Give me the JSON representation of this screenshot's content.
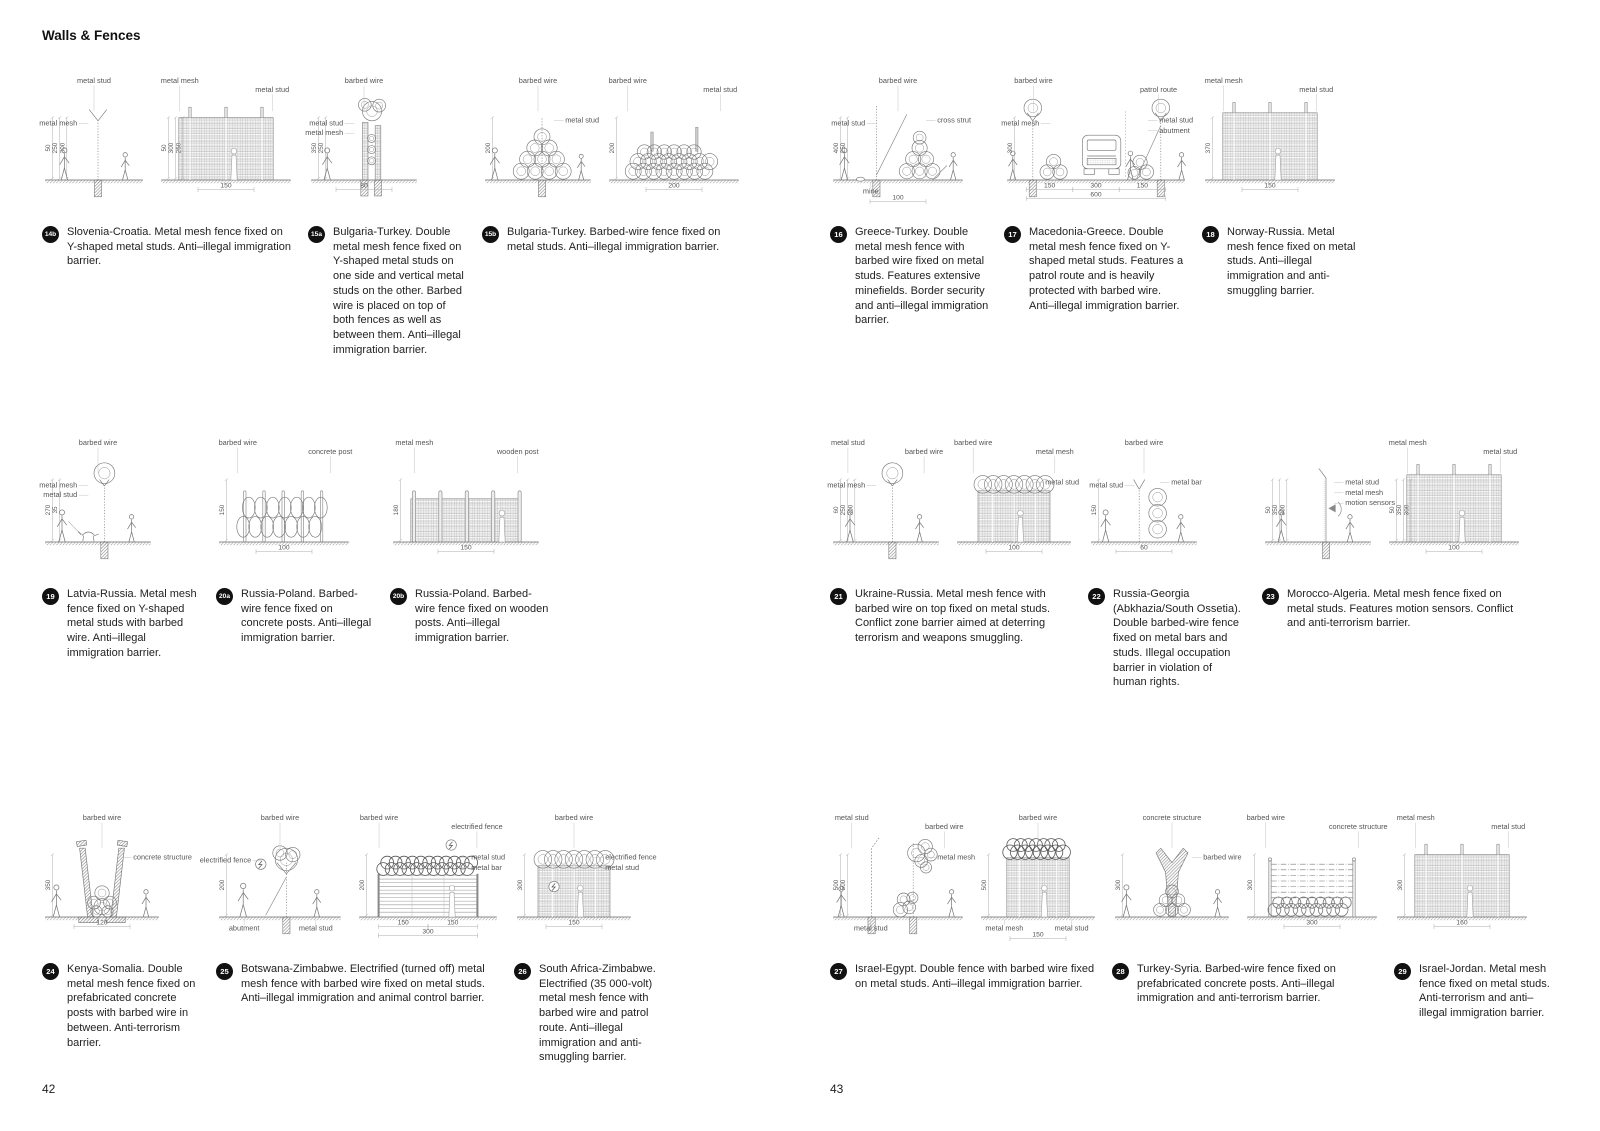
{
  "header": {
    "title": "Walls & Fences"
  },
  "colors": {
    "page_bg": "#ffffff",
    "text": "#222222",
    "badge_bg": "#111111",
    "drawing_line": "#777777",
    "dim_line": "#aaaaaa"
  },
  "pages": [
    {
      "number": "42",
      "rows": [
        [
          {
            "id": "14b",
            "caption": "Slovenia-Croatia. Metal mesh fence fixed on Y-shaped metal studs. Anti–illegal immigration barrier.",
            "drawings": [
              {
                "kind": "ypost",
                "labels": [
                  {
                    "t": "metal stud",
                    "pos": "top"
                  },
                  {
                    "t": "metal mesh",
                    "pos": "left"
                  }
                ],
                "vdims": [
                  "50",
                  "250",
                  "300"
                ],
                "hdims": []
              },
              {
                "kind": "meshwall",
                "labels": [
                  {
                    "t": "metal mesh",
                    "pos": "top"
                  },
                  {
                    "t": "metal stud",
                    "pos": "top"
                  }
                ],
                "vdims": [
                  "50",
                  "300",
                  "250"
                ],
                "hdims": [
                  "150"
                ]
              }
            ]
          },
          {
            "id": "15a",
            "caption": "Bulgaria-Turkey. Double metal mesh fence fixed on Y-shaped metal studs on one side and vertical metal studs on the other. Barbed wire is placed on top of both fences as well as between them. Anti–illegal immigration barrier.",
            "drawings": [
              {
                "kind": "doubleMeshCoil",
                "labels": [
                  {
                    "t": "barbed wire",
                    "pos": "top"
                  },
                  {
                    "t": "metal stud",
                    "pos": "left"
                  },
                  {
                    "t": "metal mesh",
                    "pos": "left"
                  }
                ],
                "vdims": [
                  "350",
                  "250"
                ],
                "hdims": [
                  "80"
                ]
              }
            ]
          },
          {
            "id": "15b",
            "caption": "Bulgaria-Turkey. Barbed-wire fence fixed on metal studs. Anti–illegal immigration barrier.",
            "drawings": [
              {
                "kind": "coilPyramid",
                "labels": [
                  {
                    "t": "barbed wire",
                    "pos": "top"
                  },
                  {
                    "t": "metal stud",
                    "pos": "right"
                  }
                ],
                "vdims": [
                  "200"
                ],
                "hdims": []
              },
              {
                "kind": "coilMound",
                "labels": [
                  {
                    "t": "barbed wire",
                    "pos": "top"
                  },
                  {
                    "t": "metal stud",
                    "pos": "top"
                  }
                ],
                "vdims": [
                  "200"
                ],
                "hdims": [
                  "200"
                ]
              }
            ]
          }
        ],
        [
          {
            "id": "19",
            "caption": "Latvia-Russia. Metal mesh fence fixed on Y-shaped metal studs with barbed wire. Anti–illegal immigration barrier.",
            "drawings": [
              {
                "kind": "postCoilTop",
                "variant": "dog",
                "labels": [
                  {
                    "t": "barbed wire",
                    "pos": "top"
                  },
                  {
                    "t": "metal mesh",
                    "pos": "left"
                  },
                  {
                    "t": "metal stud",
                    "pos": "left"
                  }
                ],
                "vdims": [
                  "270",
                  "35"
                ],
                "hdims": []
              }
            ]
          },
          {
            "id": "20a",
            "caption": "Russia-Poland. Barbed-wire fence fixed on concrete posts. Anti–illegal immigration barrier.",
            "drawings": [
              {
                "kind": "coilRows",
                "labels": [
                  {
                    "t": "barbed wire",
                    "pos": "top"
                  },
                  {
                    "t": "concrete post",
                    "pos": "top"
                  }
                ],
                "vdims": [
                  "150"
                ],
                "hdims": [
                  "100"
                ]
              }
            ]
          },
          {
            "id": "20b",
            "caption": "Russia-Poland. Barbed-wire fence fixed on wooden posts. Anti–illegal immigration barrier.",
            "drawings": [
              {
                "kind": "meshFence",
                "labels": [
                  {
                    "t": "metal mesh",
                    "pos": "top"
                  },
                  {
                    "t": "wooden post",
                    "pos": "top"
                  }
                ],
                "vdims": [
                  "180"
                ],
                "hdims": [
                  "150"
                ]
              }
            ]
          }
        ],
        [
          {
            "id": "24",
            "caption": "Kenya-Somalia. Double metal mesh fence fixed on prefabricated concrete posts with barbed wire in between. Anti-terrorism barrier.",
            "drawings": [
              {
                "kind": "vwalls",
                "labels": [
                  {
                    "t": "barbed wire",
                    "pos": "top"
                  },
                  {
                    "t": "concrete structure",
                    "pos": "right"
                  }
                ],
                "vdims": [
                  "350"
                ],
                "hdims": [
                  "120"
                ]
              }
            ]
          },
          {
            "id": "25",
            "caption": "Botswana-Zimbabwe. Electrified (turned off) metal mesh fence with barbed wire fixed on metal studs. Anti–illegal immigration and animal control barrier.",
            "drawings": [
              {
                "kind": "strutCoil",
                "labels": [
                  {
                    "t": "electrified fence",
                    "pos": "left"
                  },
                  {
                    "t": "barbed wire",
                    "pos": "top"
                  },
                  {
                    "t": "abutment",
                    "pos": "bottom"
                  },
                  {
                    "t": "metal stud",
                    "pos": "bottom"
                  }
                ],
                "vdims": [
                  "200"
                ],
                "hdims": []
              },
              {
                "kind": "barWall",
                "labels": [
                  {
                    "t": "barbed wire",
                    "pos": "top"
                  },
                  {
                    "t": "electrified fence",
                    "pos": "top"
                  },
                  {
                    "t": "metal stud",
                    "pos": "right"
                  },
                  {
                    "t": "metal bar",
                    "pos": "right"
                  }
                ],
                "vdims": [
                  "200"
                ],
                "hdims": [
                  "150",
                  "150",
                  "300"
                ]
              }
            ]
          },
          {
            "id": "26",
            "caption": "South Africa-Zimbabwe. Electrified (35 000-volt) metal mesh fence with barbed wire and patrol route. Anti–illegal immigration and anti-smuggling barrier.",
            "drawings": [
              {
                "kind": "meshCoilTop",
                "variant": "bolt",
                "labels": [
                  {
                    "t": "barbed wire",
                    "pos": "top"
                  },
                  {
                    "t": "electrified fence",
                    "pos": "right"
                  },
                  {
                    "t": "metal stud",
                    "pos": "right"
                  }
                ],
                "vdims": [
                  "300"
                ],
                "hdims": [
                  "150"
                ]
              }
            ]
          }
        ]
      ]
    },
    {
      "number": "43",
      "rows": [
        [
          {
            "id": "16",
            "caption": "Greece-Turkey. Double metal mesh fence with barbed wire fixed on metal studs. Features extensive minefields. Border security and anti–illegal immigration barrier.",
            "drawings": [
              {
                "kind": "mineSection",
                "labels": [
                  {
                    "t": "barbed wire",
                    "pos": "top"
                  },
                  {
                    "t": "metal stud",
                    "pos": "left"
                  },
                  {
                    "t": "cross strut",
                    "pos": "right"
                  },
                  {
                    "t": "mine",
                    "pos": "bottom"
                  }
                ],
                "vdims": [
                  "400",
                  "250"
                ],
                "hdims": [
                  "100"
                ]
              }
            ]
          },
          {
            "id": "17",
            "caption": "Macedonia-Greece. Double metal mesh fence fixed on Y-shaped metal studs. Features a patrol route and is heavily protected with barbed wire. Anti–illegal immigration barrier.",
            "drawings": [
              {
                "kind": "patrol",
                "labels": [
                  {
                    "t": "barbed wire",
                    "pos": "top"
                  },
                  {
                    "t": "patrol route",
                    "pos": "top"
                  },
                  {
                    "t": "metal mesh",
                    "pos": "left"
                  },
                  {
                    "t": "metal stud",
                    "pos": "right"
                  },
                  {
                    "t": "abutment",
                    "pos": "right"
                  }
                ],
                "vdims": [
                  "300"
                ],
                "hdims": [
                  "150",
                  "300",
                  "150",
                  "600"
                ]
              }
            ]
          },
          {
            "id": "18",
            "caption": "Norway-Russia. Metal mesh fence fixed on metal studs. Anti–illegal immigration and anti-smuggling barrier.",
            "drawings": [
              {
                "kind": "meshwall",
                "variant": "tall",
                "labels": [
                  {
                    "t": "metal mesh",
                    "pos": "top"
                  },
                  {
                    "t": "metal stud",
                    "pos": "top"
                  }
                ],
                "vdims": [
                  "370"
                ],
                "hdims": [
                  "150"
                ]
              }
            ]
          }
        ],
        [
          {
            "id": "21",
            "caption": "Ukraine-Russia. Metal mesh fence with barbed wire on top fixed on metal studs. Conflict zone barrier aimed at deterring terrorism and weapons smuggling.",
            "drawings": [
              {
                "kind": "postCoilTop",
                "labels": [
                  {
                    "t": "metal stud",
                    "pos": "top"
                  },
                  {
                    "t": "barbed wire",
                    "pos": "top"
                  },
                  {
                    "t": "metal mesh",
                    "pos": "left"
                  }
                ],
                "vdims": [
                  "60",
                  "250",
                  "300"
                ],
                "hdims": []
              },
              {
                "kind": "meshCoilTop",
                "labels": [
                  {
                    "t": "barbed wire",
                    "pos": "top"
                  },
                  {
                    "t": "metal mesh",
                    "pos": "top"
                  },
                  {
                    "t": "metal stud",
                    "pos": "right"
                  }
                ],
                "vdims": [],
                "hdims": [
                  "100"
                ]
              }
            ]
          },
          {
            "id": "22",
            "caption": "Russia-Georgia (Abkhazia/South Ossetia). Double barbed-wire fence fixed on metal bars and studs. Illegal occupation barrier in violation of human rights.",
            "drawings": [
              {
                "kind": "ysmallCoils",
                "labels": [
                  {
                    "t": "metal stud",
                    "pos": "left"
                  },
                  {
                    "t": "barbed wire",
                    "pos": "top"
                  },
                  {
                    "t": "metal bar",
                    "pos": "right"
                  }
                ],
                "vdims": [
                  "150"
                ],
                "hdims": [
                  "60"
                ]
              }
            ]
          },
          {
            "id": "23",
            "caption": "Morocco-Algeria. Metal mesh fence fixed on metal studs. Features motion sensors. Conflict and anti-terrorism barrier.",
            "drawings": [
              {
                "kind": "sensorPost",
                "labels": [
                  {
                    "t": "metal stud",
                    "pos": "right"
                  },
                  {
                    "t": "metal mesh",
                    "pos": "right"
                  },
                  {
                    "t": "motion sensors",
                    "pos": "right"
                  }
                ],
                "vdims": [
                  "50",
                  "350",
                  "300"
                ],
                "hdims": []
              },
              {
                "kind": "meshwall",
                "variant": "tall",
                "labels": [
                  {
                    "t": "metal mesh",
                    "pos": "top"
                  },
                  {
                    "t": "metal stud",
                    "pos": "top"
                  }
                ],
                "vdims": [
                  "50",
                  "350",
                  "300"
                ],
                "hdims": [
                  "100"
                ]
              }
            ]
          }
        ],
        [
          {
            "id": "27",
            "caption": "Israel-Egypt. Double fence with barbed wire fixed on metal studs. Anti–illegal immigration barrier.",
            "drawings": [
              {
                "kind": "doublePosts",
                "labels": [
                  {
                    "t": "metal stud",
                    "pos": "top"
                  },
                  {
                    "t": "barbed wire",
                    "pos": "top"
                  },
                  {
                    "t": "metal mesh",
                    "pos": "right"
                  },
                  {
                    "t": "metal stud",
                    "pos": "bottom"
                  }
                ],
                "vdims": [
                  "500",
                  "500"
                ],
                "hdims": []
              },
              {
                "kind": "meshCoilTop",
                "variant": "tall",
                "labels": [
                  {
                    "t": "barbed wire",
                    "pos": "top"
                  },
                  {
                    "t": "metal mesh",
                    "pos": "bottom"
                  },
                  {
                    "t": "metal stud",
                    "pos": "bottom"
                  }
                ],
                "vdims": [
                  "500"
                ],
                "hdims": [
                  "150"
                ]
              }
            ]
          },
          {
            "id": "28",
            "caption": "Turkey-Syria. Barbed-wire fence fixed on prefabricated concrete posts. Anti–illegal immigration and anti-terrorism barrier.",
            "drawings": [
              {
                "kind": "yconcrete",
                "labels": [
                  {
                    "t": "concrete structure",
                    "pos": "top"
                  },
                  {
                    "t": "barbed wire",
                    "pos": "right"
                  }
                ],
                "vdims": [
                  "300"
                ],
                "hdims": []
              },
              {
                "kind": "wireLines",
                "labels": [
                  {
                    "t": "barbed wire",
                    "pos": "top"
                  },
                  {
                    "t": "concrete structure",
                    "pos": "top"
                  }
                ],
                "vdims": [
                  "300"
                ],
                "hdims": [
                  "300"
                ]
              }
            ]
          },
          {
            "id": "29",
            "caption": "Israel-Jordan. Metal mesh fence fixed on metal studs. Anti-terrorism and anti–illegal immigration barrier.",
            "drawings": [
              {
                "kind": "meshwall",
                "labels": [
                  {
                    "t": "metal mesh",
                    "pos": "top"
                  },
                  {
                    "t": "metal stud",
                    "pos": "top"
                  }
                ],
                "vdims": [
                  "300"
                ],
                "hdims": [
                  "160"
                ]
              }
            ]
          }
        ]
      ]
    }
  ]
}
